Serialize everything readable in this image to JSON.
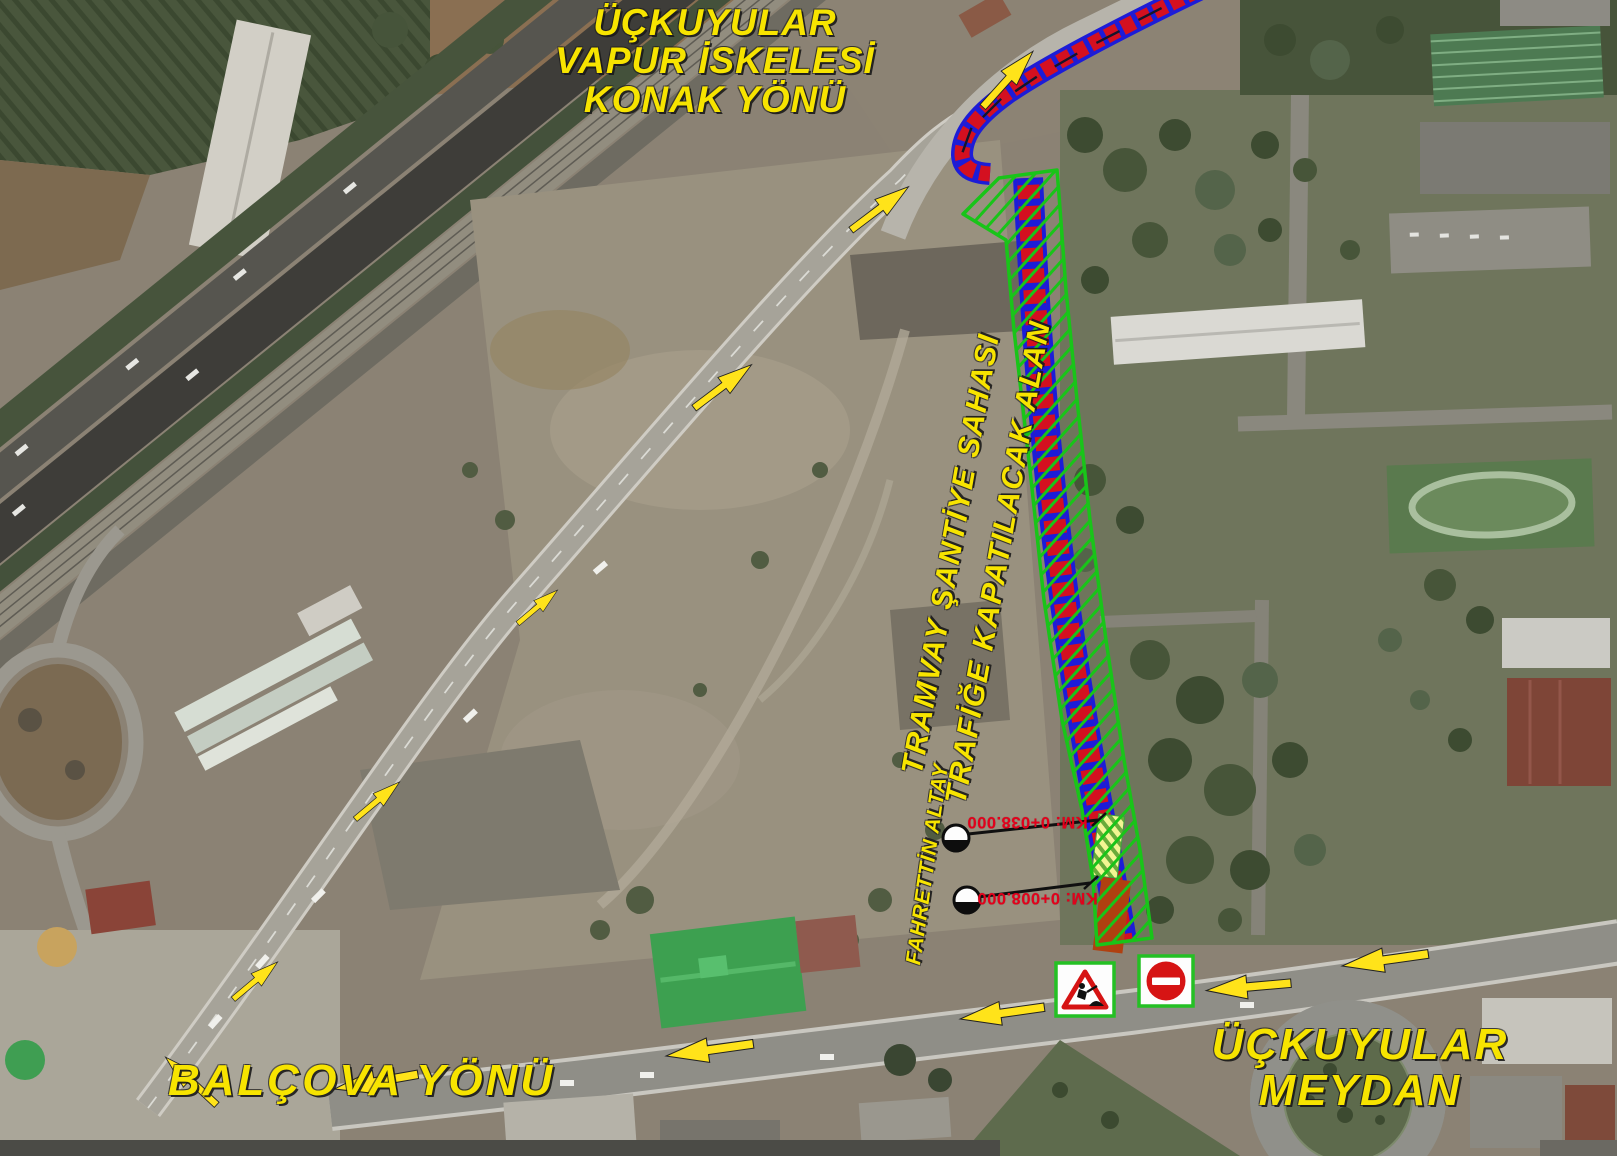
{
  "colors": {
    "label_yellow": "#f7e400",
    "chainage_red": "#e3001b",
    "zone_green": "#19c419",
    "tram_blue": "#1c1cd8",
    "tram_red": "#d41020",
    "arrow_yellow": "#ffe31a",
    "sign_border_green": "#24c024",
    "sign_red": "#d61414"
  },
  "labels": {
    "ferry_direction": {
      "line1": "ÜÇKUYULAR",
      "line2": "VAPUR İSKELESİ",
      "line3": "KONAK YÖNÜ"
    },
    "closure_zone": {
      "line1": "TRAMVAY ŞANTİYE SAHASI",
      "line2": "TRAFİĞE KAPATILACAK ALAN"
    },
    "street": "FAHRETTİN ALTAY",
    "balcova_direction": "BALÇOVA YÖNÜ",
    "square": {
      "line1": "ÜÇKUYULAR",
      "line2": "MEYDAN"
    }
  },
  "chainage": {
    "start": "KM: 0+038.000",
    "end": "KM: 0+008.000"
  },
  "icons": {
    "roadworks_sign": "roadworks-warning",
    "no_entry_sign": "no-entry",
    "direction_arrow": "yellow-direction-arrow",
    "chainage_marker": "survey-benchmark"
  }
}
